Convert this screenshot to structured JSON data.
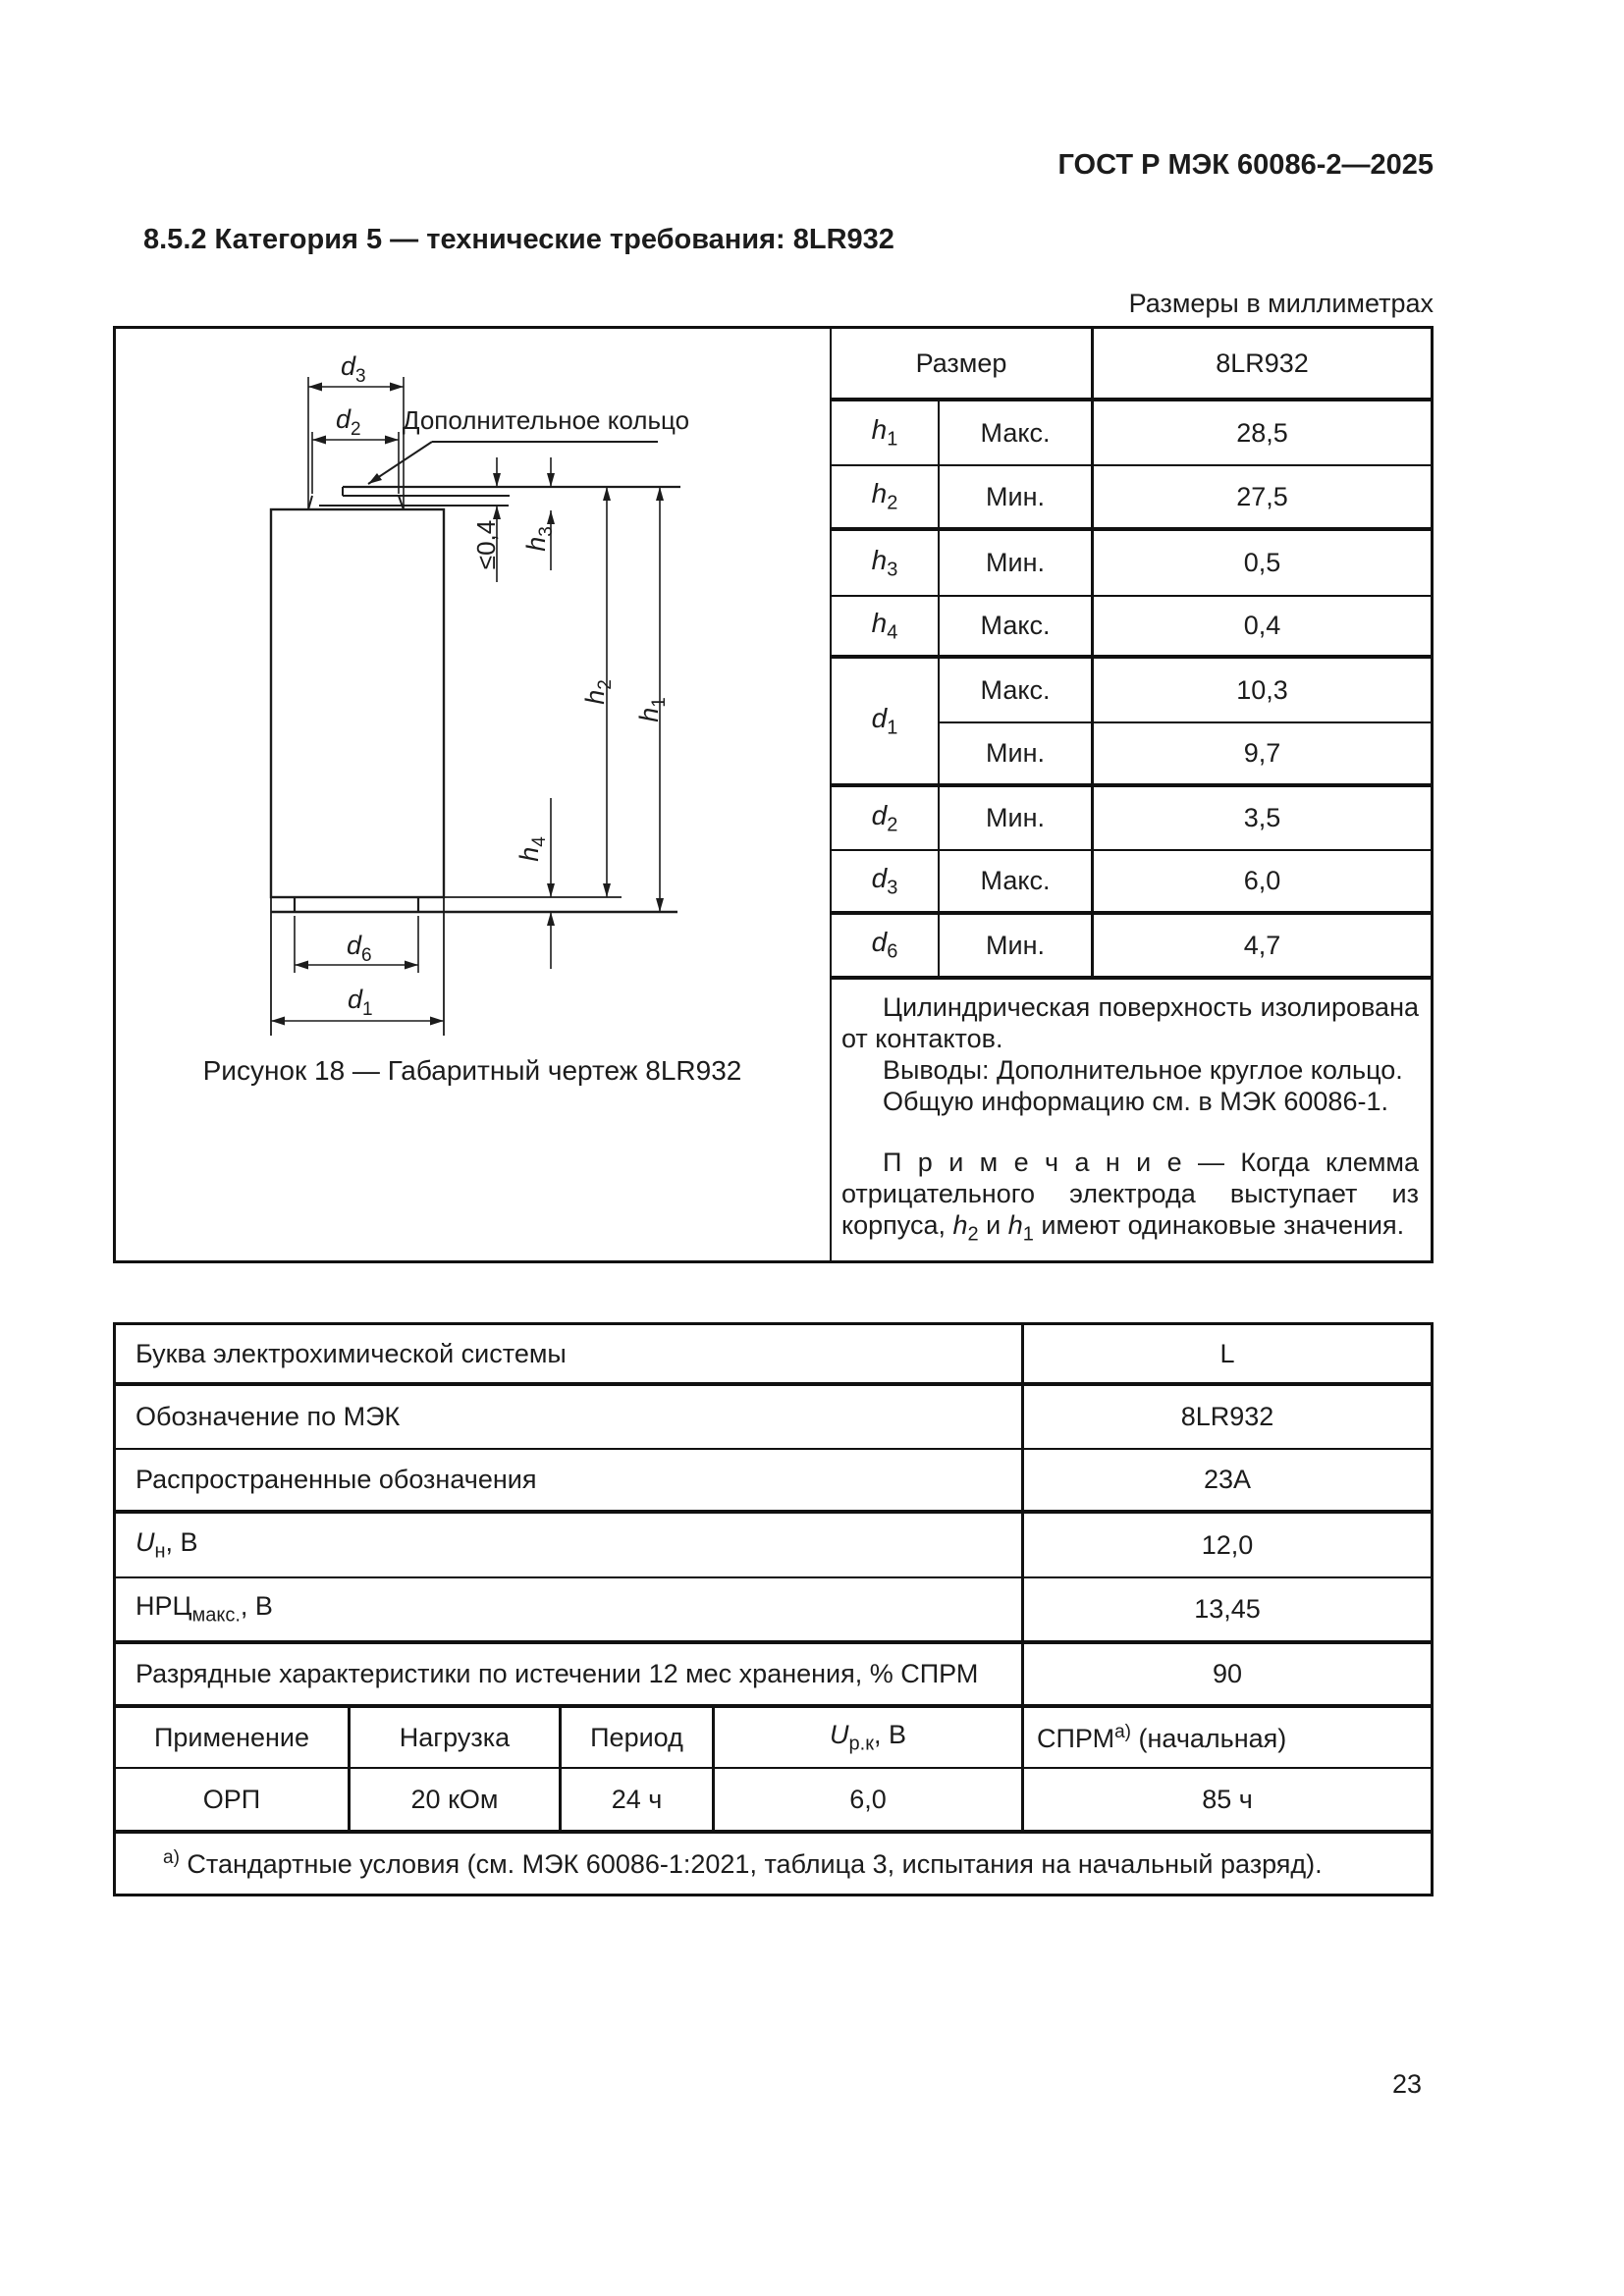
{
  "header": {
    "code": "ГОСТ Р МЭК 60086-2—2025",
    "section_heading": "8.5.2 Категория 5 — технические требования: 8LR932",
    "units_note": "Размеры в миллиметрах"
  },
  "figure": {
    "caption": "Рисунок 18 — Габаритный чертеж 8LR932",
    "leader_label": "Дополнительное кольцо",
    "dims": {
      "d3": {
        "sym": "d",
        "sub": "3"
      },
      "d2": {
        "sym": "d",
        "sub": "2"
      },
      "max04": "≤0,4",
      "h3": {
        "sym": "h",
        "sub": "3"
      },
      "h2": {
        "sym": "h",
        "sub": "2"
      },
      "h1": {
        "sym": "h",
        "sub": "1"
      },
      "h4": {
        "sym": "h",
        "sub": "4"
      },
      "d6": {
        "sym": "d",
        "sub": "6"
      },
      "d1": {
        "sym": "d",
        "sub": "1"
      }
    }
  },
  "dim_table": {
    "header": {
      "col1": "Размер",
      "col2": "8LR932"
    },
    "rows": [
      {
        "name_sym": "h",
        "name_sub": "1",
        "limit": "Макс.",
        "value": "28,5"
      },
      {
        "name_sym": "h",
        "name_sub": "2",
        "limit": "Мин.",
        "value": "27,5"
      },
      {
        "name_sym": "h",
        "name_sub": "3",
        "limit": "Мин.",
        "value": "0,5"
      },
      {
        "name_sym": "h",
        "name_sub": "4",
        "limit": "Макс.",
        "value": "0,4"
      },
      {
        "name_sym": "d",
        "name_sub": "1",
        "limit": "Макс.",
        "value": "10,3"
      },
      {
        "limit": "Мин.",
        "value": "9,7"
      },
      {
        "name_sym": "d",
        "name_sub": "2",
        "limit": "Мин.",
        "value": "3,5"
      },
      {
        "name_sym": "d",
        "name_sub": "3",
        "limit": "Макс.",
        "value": "6,0"
      },
      {
        "name_sym": "d",
        "name_sub": "6",
        "limit": "Мин.",
        "value": "4,7"
      }
    ]
  },
  "notes": {
    "line1": "Цилиндрическая поверхность изолирована от контактов.",
    "line2": "Выводы: Дополнительное круглое кольцо.",
    "line3": "Общую информацию см. в МЭК 60086-1.",
    "note_prefix": "П р и м е ч а н и е  — Когда клемма отрицательного электрода выступает из корпуса, ",
    "h2_sym": "h",
    "h2_sub": "2",
    "and_word": " и ",
    "h1_sym": "h",
    "h1_sub": "1",
    "note_suffix": " имеют одинаковые значения."
  },
  "char_table": {
    "rows": [
      {
        "label": "Буква электрохимической системы",
        "value": "L"
      },
      {
        "label": "Обозначение по МЭК",
        "value": "8LR932"
      },
      {
        "label": "Распространенные обозначения",
        "value": "23А"
      },
      {
        "label_sym": "U",
        "label_sub": "н",
        "label_rest": ", В",
        "value": "12,0"
      },
      {
        "label_pre": "НРЦ",
        "label_sub": "макс.",
        "label_rest": ", В",
        "value": "13,45"
      },
      {
        "label": "Разрядные характеристики по истечении 12 мес хранения, % СПРМ",
        "value": "90"
      }
    ],
    "app_header": {
      "col1": "Применение",
      "col2": "Нагрузка",
      "col3": "Период",
      "col4_sym": "U",
      "col4_sub": "р.к",
      "col4_rest": ", В",
      "col5_pre": "СПРМ",
      "col5_sup": "а)",
      "col5_rest": " (начальная)"
    },
    "app_row": {
      "col1": "ОРП",
      "col2": "20 кОм",
      "col3": "24 ч",
      "col4": "6,0",
      "col5": "85 ч"
    },
    "footnote": {
      "sup": "а)",
      "text": " Стандартные условия (см. МЭК 60086-1:2021, таблица 3, испытания на начальный разряд)."
    }
  },
  "page": {
    "number": "23"
  }
}
